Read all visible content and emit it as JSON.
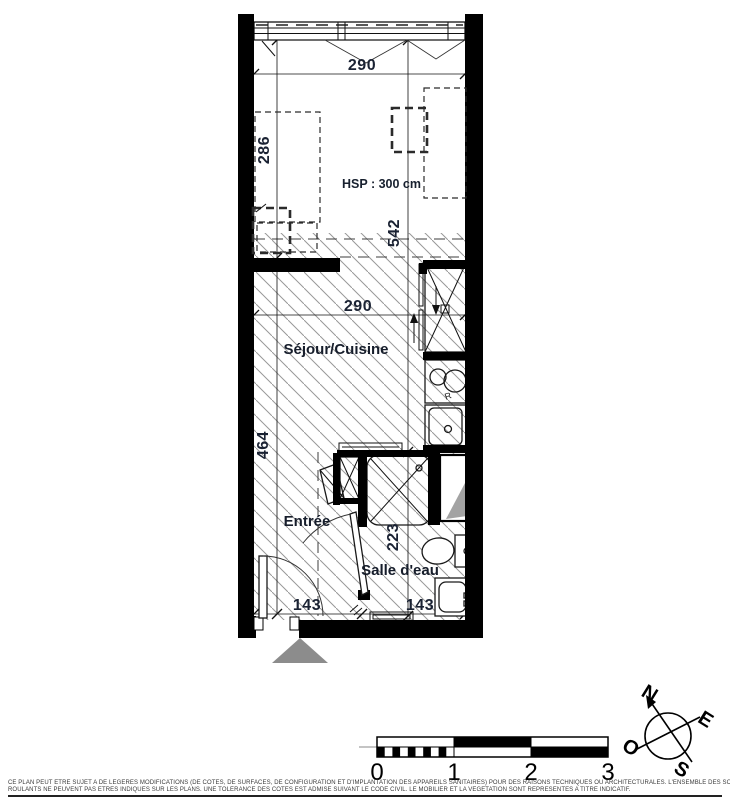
{
  "plan": {
    "rooms": {
      "living": "Séjour/Cuisine",
      "entry": "Entrée",
      "bath": "Salle d'eau"
    },
    "ceiling_note": "HSP : 300 cm",
    "dims": {
      "top_width": "290",
      "upper_room_depth": "286",
      "total_depth": "542",
      "living_width": "290",
      "lower_depth": "464",
      "bath_depth": "223",
      "entry_width": "143",
      "bath_width": "143"
    },
    "kitchen_mark": "R"
  },
  "compass": {
    "n": "N",
    "e": "E",
    "s": "S",
    "o": "O"
  },
  "scale_bar": {
    "t0": "0",
    "t1": "1",
    "t2": "2",
    "t3": "3"
  },
  "footer": {
    "line1": "CE PLAN PEUT ETRE SUJET A DE LEGERES MODIFICATIONS (DE COTES, DE SURFACES, DE CONFIGURATION ET D'IMPLANTATION DES APPAREILS SANITAIRES) POUR DES RAISONS TECHNIQUES OU ARCHITECTURALES. L'ENSEMBLE DES SOFFITES, RETOMBÉES DE POUTRES ET VOLETS",
    "line2": "ROULANTS NE PEUVENT PAS ETRES INDIQUES SUR LES PLANS. UNE TOLERANCE DES COTES EST ADMISE SUIVANT LE CODE CIVIL. LE MOBILIER ET LA VEGETATION SONT REPRESENTES A TITRE INDICATIF."
  },
  "colors": {
    "hatch": "#989898",
    "entrance_triangle": "#8c8c8c",
    "duct_shade": "#a3a3a3"
  }
}
